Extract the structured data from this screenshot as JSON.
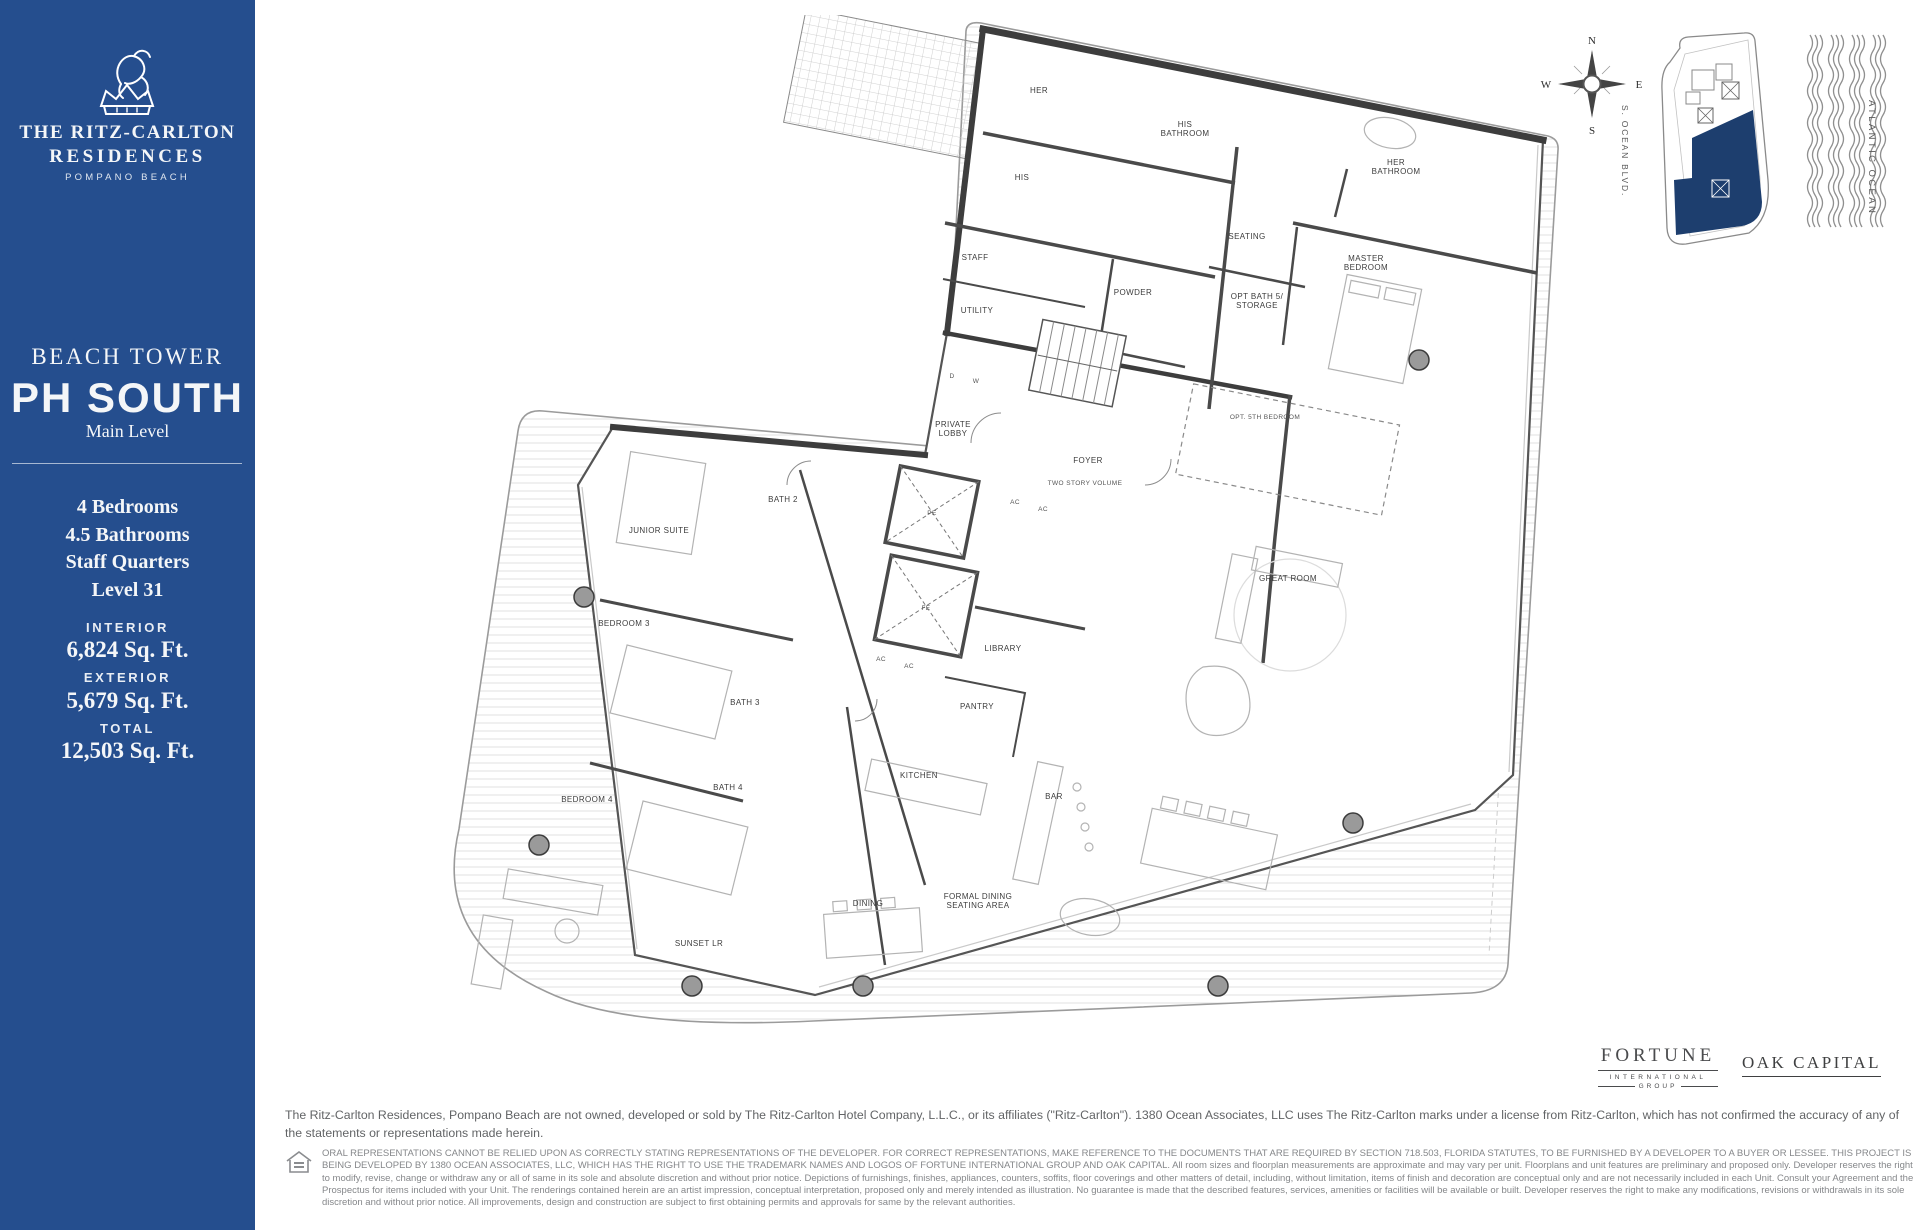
{
  "sidebar": {
    "background": "#254e8e",
    "brand": {
      "line1": "THE RITZ-CARLTON",
      "line2": "RESIDENCES",
      "location": "POMPANO BEACH"
    },
    "tower": "BEACH TOWER",
    "unit": "PH SOUTH",
    "level": "Main Level",
    "specs": [
      "4 Bedrooms",
      "4.5 Bathrooms",
      "Staff Quarters",
      "Level 31"
    ],
    "areas": [
      {
        "label": "INTERIOR",
        "value": "6,824 Sq. Ft."
      },
      {
        "label": "EXTERIOR",
        "value": "5,679 Sq. Ft."
      },
      {
        "label": "TOTAL",
        "value": "12,503  Sq. Ft."
      }
    ]
  },
  "floorplan": {
    "rooms": [
      {
        "label": "HER",
        "x": 654,
        "y": 78
      },
      {
        "label": "HIS",
        "x": 637,
        "y": 165
      },
      {
        "label": "HIS BATHROOM",
        "lines": [
          "HIS",
          "BATHROOM"
        ],
        "x": 800,
        "y": 112
      },
      {
        "label": "HER BATHROOM",
        "lines": [
          "HER",
          "BATHROOM"
        ],
        "x": 1011,
        "y": 150
      },
      {
        "label": "SEATING",
        "x": 862,
        "y": 224
      },
      {
        "label": "MASTER BEDROOM",
        "lines": [
          "MASTER",
          "BEDROOM"
        ],
        "x": 981,
        "y": 246
      },
      {
        "label": "STAFF",
        "x": 590,
        "y": 245
      },
      {
        "label": "POWDER",
        "x": 748,
        "y": 280
      },
      {
        "label": "UTILITY",
        "x": 592,
        "y": 298
      },
      {
        "label": "OPT BATH 5/ STORAGE",
        "lines": [
          "OPT BATH 5/",
          "STORAGE"
        ],
        "x": 872,
        "y": 284
      },
      {
        "label": "OPT. 5TH BEDROOM",
        "x": 880,
        "y": 404,
        "small": true
      },
      {
        "label": "PRIVATE LOBBY",
        "lines": [
          "PRIVATE",
          "LOBBY"
        ],
        "x": 568,
        "y": 412
      },
      {
        "label": "FOYER",
        "x": 703,
        "y": 448
      },
      {
        "label": "TWO STORY VOLUME",
        "x": 700,
        "y": 470,
        "small": true
      },
      {
        "label": "GREAT ROOM",
        "x": 903,
        "y": 566
      },
      {
        "label": "LIBRARY",
        "x": 618,
        "y": 636
      },
      {
        "label": "PANTRY",
        "x": 592,
        "y": 694
      },
      {
        "label": "KITCHEN",
        "x": 534,
        "y": 763
      },
      {
        "label": "BAR",
        "x": 669,
        "y": 784
      },
      {
        "label": "DINING",
        "x": 483,
        "y": 891
      },
      {
        "label": "FORMAL DINING SEATING AREA",
        "lines": [
          "FORMAL DINING",
          "SEATING AREA"
        ],
        "x": 593,
        "y": 884
      },
      {
        "label": "SUNSET LR",
        "x": 314,
        "y": 931
      },
      {
        "label": "JUNIOR SUITE",
        "x": 274,
        "y": 518
      },
      {
        "label": "BATH 2",
        "x": 398,
        "y": 487
      },
      {
        "label": "BEDROOM 3",
        "x": 239,
        "y": 611
      },
      {
        "label": "BATH 3",
        "x": 360,
        "y": 690
      },
      {
        "label": "BEDROOM 4",
        "x": 202,
        "y": 787
      },
      {
        "label": "BATH 4",
        "x": 343,
        "y": 775
      },
      {
        "label": "AC",
        "x": 630,
        "y": 489,
        "small": true
      },
      {
        "label": "AC",
        "x": 658,
        "y": 496,
        "small": true
      },
      {
        "label": "AC",
        "x": 496,
        "y": 646,
        "small": true
      },
      {
        "label": "AC",
        "x": 524,
        "y": 653,
        "small": true
      },
      {
        "label": "D",
        "x": 567,
        "y": 363,
        "small": true
      },
      {
        "label": "W",
        "x": 591,
        "y": 368,
        "small": true
      },
      {
        "label": "PE",
        "x": 547,
        "y": 500,
        "small": true
      },
      {
        "label": "FE",
        "x": 541,
        "y": 595,
        "small": true
      }
    ],
    "columns": [
      [
        1034,
        345
      ],
      [
        199,
        582
      ],
      [
        154,
        830
      ],
      [
        307,
        971
      ],
      [
        478,
        971
      ],
      [
        833,
        971
      ],
      [
        968,
        808
      ]
    ]
  },
  "map_key": {
    "compass": {
      "n": "N",
      "e": "E",
      "s": "S",
      "w": "W"
    },
    "street": "S. OCEAN BLVD.",
    "ocean": "ATLANTIC OCEAN",
    "unit_fill": "#1d3e6e"
  },
  "footer": {
    "fortune_logo": {
      "line1": "FORTUNE",
      "line2": "INTERNATIONAL",
      "line3": "GROUP"
    },
    "oak_logo": "OAK CAPITAL",
    "disclaimer1": "The Ritz-Carlton Residences, Pompano Beach are not owned, developed or sold by The Ritz-Carlton Hotel Company, L.L.C., or its affiliates (\"Ritz-Carlton\"). 1380 Ocean Associates, LLC uses The Ritz-Carlton marks under a license from Ritz-Carlton, which has not confirmed the accuracy of any of the statements or representations made herein.",
    "disclaimer2": "ORAL REPRESENTATIONS CANNOT BE RELIED UPON AS CORRECTLY STATING REPRESENTATIONS OF THE DEVELOPER. FOR CORRECT REPRESENTATIONS, MAKE REFERENCE TO THE DOCUMENTS THAT ARE REQUIRED BY SECTION 718.503, FLORIDA STATUTES, TO BE FURNISHED BY A DEVELOPER TO A BUYER OR LESSEE. THIS PROJECT IS BEING DEVELOPED BY 1380 OCEAN ASSOCIATES, LLC, WHICH HAS THE RIGHT TO USE THE TRADEMARK NAMES AND LOGOS OF FORTUNE INTERNATIONAL GROUP AND OAK CAPITAL. All room sizes and floorplan measurements are approximate and may vary per unit. Floorplans and unit features are preliminary and proposed only. Developer reserves the right to modify, revise, change or withdraw any or all of same in its sole and absolute discretion and without prior notice. Depictions of furnishings, finishes, appliances, counters, soffits, floor coverings and other matters of detail, including, without limitation, items of finish and decoration are conceptual only and are not necessarily included in each Unit. Consult your Agreement and the Prospectus for items included with your Unit. The renderings contained herein are an artist impression, conceptual interpretation, proposed only and merely intended as illustration. No guarantee is made that the described features, services, amenities or facilities will be available or built. Developer reserves the right to make any modifications, revisions or withdrawals in its sole discretion and without prior notice. All improvements, design and construction are subject to first obtaining permits and approvals for same by the relevant authorities."
  }
}
